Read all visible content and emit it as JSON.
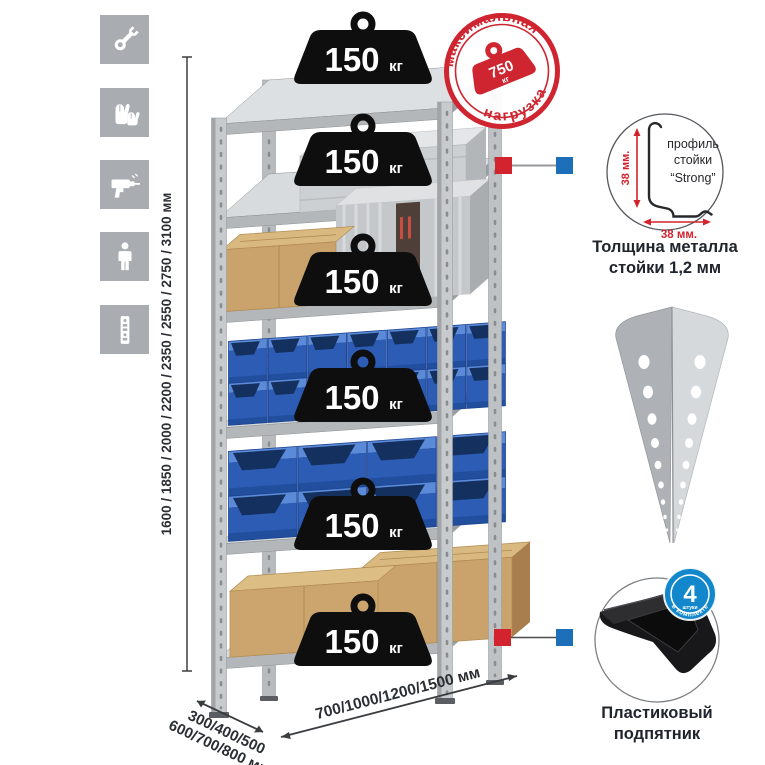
{
  "tools_panel": {
    "icons": [
      {
        "name": "wrench"
      },
      {
        "name": "gloves"
      },
      {
        "name": "drill"
      },
      {
        "name": "person"
      },
      {
        "name": "rack-post"
      }
    ]
  },
  "rack": {
    "shelf_count": 6,
    "weight_unit": "кг",
    "weights": [
      {
        "value": "150",
        "unit": "кг"
      },
      {
        "value": "150",
        "unit": "кг"
      },
      {
        "value": "150",
        "unit": "кг"
      },
      {
        "value": "150",
        "unit": "кг"
      },
      {
        "value": "150",
        "unit": "кг"
      },
      {
        "value": "150",
        "unit": "кг"
      }
    ]
  },
  "max_load_stamp": {
    "arc_top": "максимальная",
    "arc_bottom": "нагрузка",
    "value": "750",
    "unit": "кг"
  },
  "dimensions": {
    "height": "1600 / 1850 / 2000 / 2200 / 2350 / 2550 / 2750 / 3100 мм",
    "depth_line1": "300/400/500",
    "depth_line2": "600/700/800 мм",
    "width": "700/1000/1200/1500 мм"
  },
  "profile_detail": {
    "label_line1": "профиль",
    "label_line2": "стойки",
    "label_line3": "“Strong”",
    "dim_vertical": "38 мм.",
    "dim_horizontal": "38 мм.",
    "caption_line1": "Толщина металла",
    "caption_line2": "стойки 1,2 мм"
  },
  "post_detail": {
    "name": "perforated-angle-post"
  },
  "foot_detail": {
    "badge_value": "4",
    "badge_small": "штуки",
    "badge_arc": "в комплекте",
    "caption_line1": "Пластиковый",
    "caption_line2": "подпятник"
  },
  "colors": {
    "accent_red": "#d2232e",
    "accent_blue": "#1c6fb8",
    "badge_blue": "#1387cb",
    "bin_blue": "#2d5cb5",
    "metal_gray": "#c8cbce",
    "tile_gray": "#a9adb2",
    "weight_black": "#0e0e0e",
    "cardboard": "#c9a36b"
  }
}
